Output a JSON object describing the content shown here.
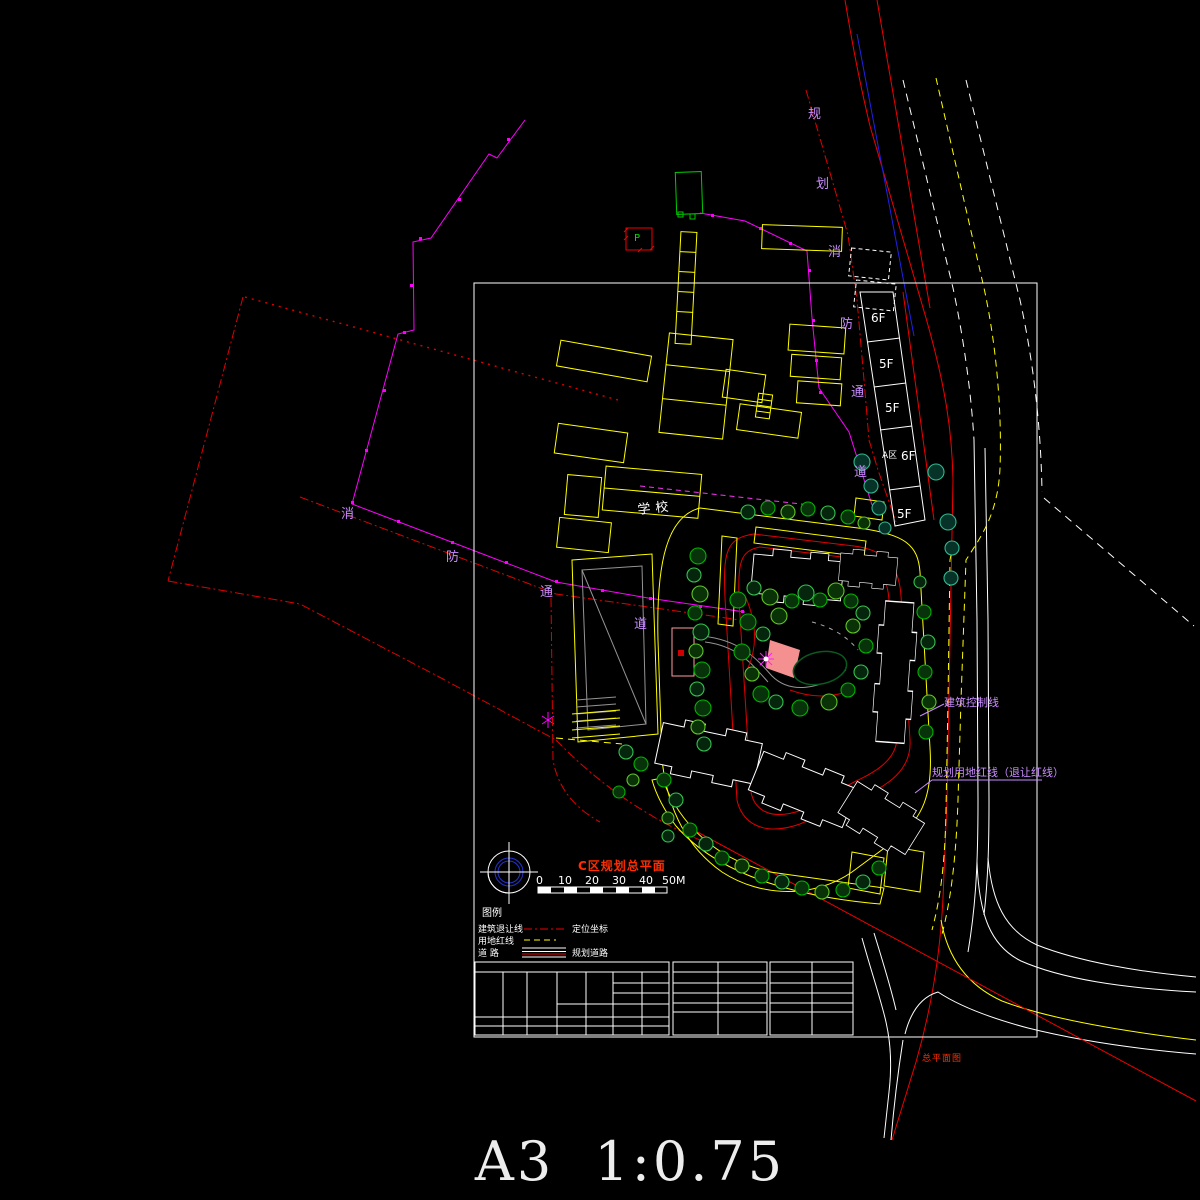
{
  "sheet": {
    "format_scale": "A3 1:0.75"
  },
  "titlebar": {
    "title": "C区规划总平面",
    "stamp": "总平面图"
  },
  "scalebar": {
    "labels": [
      "0",
      "10",
      "20",
      "30",
      "40",
      "50M"
    ]
  },
  "legend": {
    "title": "图例",
    "rows": [
      {
        "name": "建筑退让线",
        "right": "定位坐标"
      },
      {
        "name": "用地红线",
        "right": ""
      },
      {
        "name": "道  路",
        "right": "规划道路"
      }
    ]
  },
  "annotations": {
    "fire_lane_ne": [
      "规",
      "划",
      "消",
      "防",
      "通",
      "道"
    ],
    "fire_lane_sw": [
      "消",
      "防",
      "通",
      "道"
    ],
    "building_control_line": "建筑控制线",
    "planning_redline": "规划用地红线（退让红线）",
    "school": "学校",
    "parking_p": "P"
  },
  "buildings": {
    "zone_label": "A区",
    "floor_labels": [
      "6F",
      "5F",
      "5F",
      "6F",
      "5F"
    ]
  },
  "colors": {
    "background": "#000000",
    "boundary_magenta": "#ff00ff",
    "setback_red": "#e00000",
    "land_redline_yellow": "#ffff00",
    "road_edge_white": "#ffffff",
    "road_blue": "#2020e8",
    "tree_green": "#00b400",
    "tree_teal": "#2fb890",
    "annotation_purple": "#c98cff",
    "title_red": "#ff2d00",
    "plaza_pink": "#f49090",
    "hatch_orange": "#ff9900",
    "path_gray": "#949494"
  }
}
